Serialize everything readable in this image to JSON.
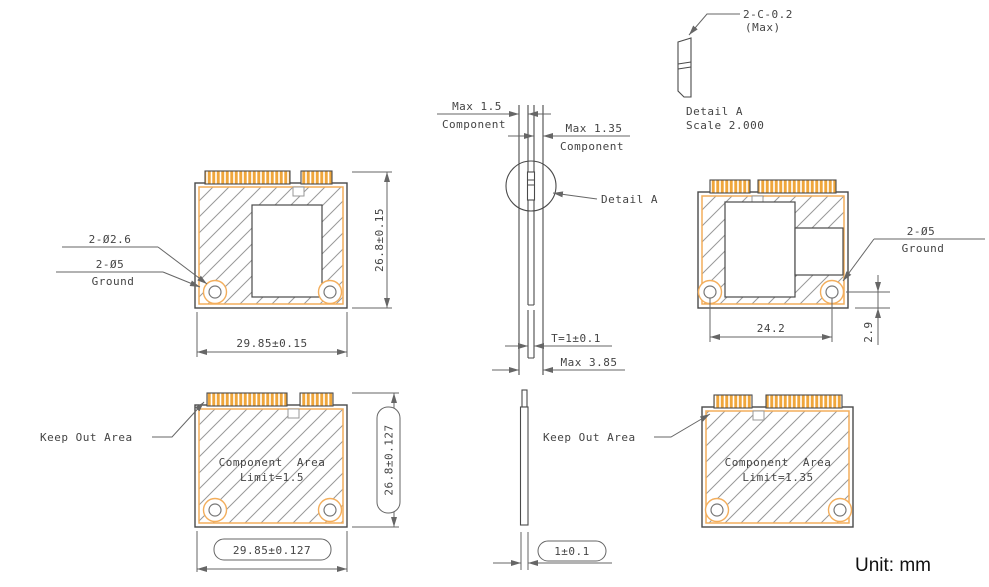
{
  "labels": {
    "chamfer": "2-C-0.2",
    "chamfer_max": "(Max)",
    "detail_title": "Detail A",
    "detail_scale": "Scale 2.000",
    "max_component_15": "Max 1.5",
    "max_component_135": "Max 1.35",
    "component_word": "Component",
    "detail_callout": "Detail A",
    "thickness": "T=1±0.1",
    "max_total": "Max 3.85",
    "bottom_thickness": "1±0.1",
    "keep_out": "Keep Out Area",
    "hole_small": "2-Ø2.6",
    "hole_large": "2-Ø5",
    "ground": "Ground",
    "unit": "Unit: mm"
  },
  "dimensions": {
    "top_height": "26.8±0.15",
    "top_width": "29.85±0.15",
    "bottom_height": "26.8±0.127",
    "bottom_width": "29.85±0.127",
    "hole_span": "24.2",
    "hole_edge_offset": "2.9",
    "comp_area_top_line1": "Component Area",
    "comp_area_top_line2": "Limit=1.5",
    "comp_area_bottom_line1": "Component Area",
    "comp_area_bottom_line2": "Limit=1.35"
  },
  "colors": {
    "outline": "#4a4a4a",
    "orange": "#F3AE5C",
    "fingers": "#EFA63B",
    "hatch": "#999999",
    "dim": "#666666",
    "text": "#444444"
  }
}
